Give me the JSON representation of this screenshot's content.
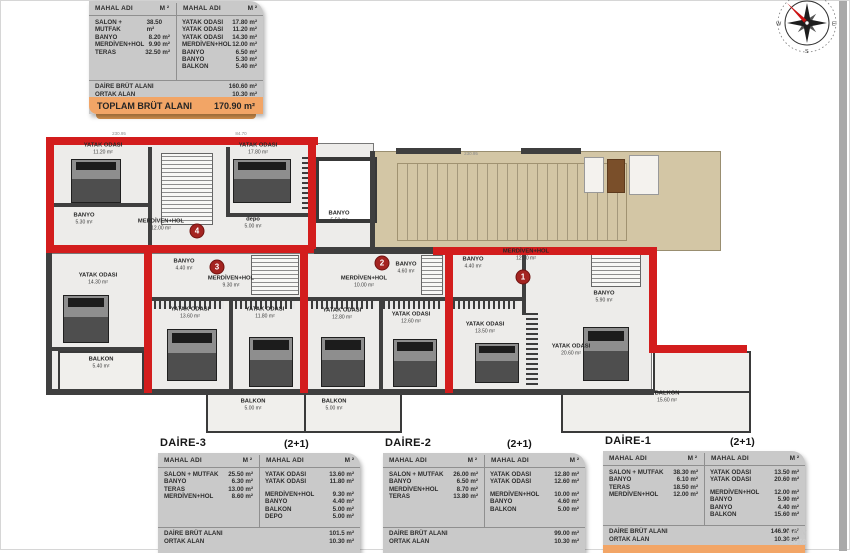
{
  "table_header": {
    "col": "MAHAL ADI",
    "unit": "M ²"
  },
  "summary_table": {
    "left_rows": [
      {
        "name": "SALON + MUTFAK",
        "value": "38.50 m²"
      },
      {
        "name": "BANYO",
        "value": "8.20 m²"
      },
      {
        "name": "MERDİVEN+HOL",
        "value": "9.90 m²"
      },
      {
        "name": "TERAS",
        "value": "32.50 m²"
      }
    ],
    "right_rows": [
      {
        "name": "YATAK ODASI",
        "value": "17.80 m²"
      },
      {
        "name": "YATAK ODASI",
        "value": "11.20 m²"
      },
      {
        "name": "YATAK ODASI",
        "value": "14.30 m²"
      },
      {
        "name": "MERDİVEN+HOL",
        "value": "12.00 m²"
      },
      {
        "name": "BANYO",
        "value": "6.50 m²"
      },
      {
        "name": "BANYO",
        "value": "5.30 m²"
      },
      {
        "name": "BALKON",
        "value": "5.40 m²"
      }
    ],
    "brut": {
      "label": "DAİRE BRÜT ALANI",
      "value": "160.60 m²"
    },
    "ortak": {
      "label": "ORTAK ALAN",
      "value": "10.30 m²"
    },
    "total": {
      "label": "TOPLAM BRÜT ALANI",
      "value": "170.90 m²"
    }
  },
  "apartments": [
    {
      "title": "DAİRE-3",
      "type": "(2+1)",
      "left_rows": [
        {
          "name": "SALON + MUTFAK",
          "value": "25.50 m²"
        },
        {
          "name": "BANYO",
          "value": "6.30 m²"
        },
        {
          "name": "TERAS",
          "value": "13.00 m²"
        },
        {
          "name": "MERDİVEN+HOL",
          "value": "8.60 m²"
        }
      ],
      "right_rows": [
        {
          "name": "YATAK ODASI",
          "value": "13.60 m²"
        },
        {
          "name": "YATAK ODASI",
          "value": "11.80 m²"
        },
        {
          "name": "MERDİVEN+HOL",
          "value": "9.30 m²"
        },
        {
          "name": "BANYO",
          "value": "4.40 m²"
        },
        {
          "name": "BALKON",
          "value": "5.00 m²"
        },
        {
          "name": "DEPO",
          "value": "5.00 m²"
        }
      ],
      "brut": {
        "label": "DAİRE BRÜT ALANI",
        "value": "101.5 m²"
      },
      "ortak": {
        "label": "ORTAK ALAN",
        "value": "10.30 m²"
      }
    },
    {
      "title": "DAİRE-2",
      "type": "(2+1)",
      "left_rows": [
        {
          "name": "SALON + MUTFAK",
          "value": "26.00 m²"
        },
        {
          "name": "BANYO",
          "value": "6.50 m²"
        },
        {
          "name": "MERDİVEN+HOL",
          "value": "8.70 m²"
        },
        {
          "name": "TERAS",
          "value": "13.80 m²"
        }
      ],
      "right_rows": [
        {
          "name": "YATAK ODASI",
          "value": "12.80 m²"
        },
        {
          "name": "YATAK ODASI",
          "value": "12.60 m²"
        },
        {
          "name": "MERDİVEN+HOL",
          "value": "10.00 m²"
        },
        {
          "name": "BANYO",
          "value": "4.60 m²"
        },
        {
          "name": "BALKON",
          "value": "5.00 m²"
        }
      ],
      "brut": {
        "label": "DAİRE BRÜT ALANI",
        "value": "99.00 m²"
      },
      "ortak": {
        "label": "ORTAK ALAN",
        "value": "10.30 m²"
      }
    },
    {
      "title": "DAİRE-1",
      "type": "(2+1)",
      "left_rows": [
        {
          "name": "SALON + MUTFAK",
          "value": "38.30 m²"
        },
        {
          "name": "BANYO",
          "value": "6.10 m²"
        },
        {
          "name": "TERAS",
          "value": "18.50 m²"
        },
        {
          "name": "MERDİVEN+HOL",
          "value": "12.00 m²"
        }
      ],
      "right_rows": [
        {
          "name": "YATAK ODASI",
          "value": "13.50 m²"
        },
        {
          "name": "YATAK ODASI",
          "value": "20.60 m²"
        },
        {
          "name": "MERDİVEN+HOL",
          "value": "12.00 m²"
        },
        {
          "name": "BANYO",
          "value": "5.90 m²"
        },
        {
          "name": "BANYO",
          "value": "4.40 m²"
        },
        {
          "name": "BALKON",
          "value": "15.60 m²"
        }
      ],
      "brut": {
        "label": "DAİRE BRÜT ALANI",
        "value": "146.90 m²"
      },
      "ortak": {
        "label": "ORTAK ALAN",
        "value": "10.30 m²"
      }
    }
  ],
  "plan": {
    "labels": [
      {
        "name": "YATAK ODASI",
        "area": "11.20 m²"
      },
      {
        "name": "YATAK ODASI",
        "area": "17.80 m²"
      },
      {
        "name": "BANYO",
        "area": "5.30 m²"
      },
      {
        "name": "MERDİVEN+HOL",
        "area": "12.00 m²"
      },
      {
        "name": "depo",
        "area": "5.00 m²"
      },
      {
        "name": "BANYO",
        "area": "5.50 m²"
      },
      {
        "name": "BANYO",
        "area": "4.40 m²"
      },
      {
        "name": "MERDİVEN+HOL",
        "area": "9.30 m²"
      },
      {
        "name": "BANYO",
        "area": "4.60 m²"
      },
      {
        "name": "MERDİVEN+HOL",
        "area": "10.00 m²"
      },
      {
        "name": "MERDİVEN+HOL",
        "area": "12.00 m²"
      },
      {
        "name": "BANYO",
        "area": "4.40 m²"
      },
      {
        "name": "BANYO",
        "area": "5.90 m²"
      },
      {
        "name": "YATAK ODASI",
        "area": "14.30 m²"
      },
      {
        "name": "YATAK ODASI",
        "area": "13.60 m²"
      },
      {
        "name": "YATAK ODASI",
        "area": "11.80 m²"
      },
      {
        "name": "YATAK ODASI",
        "area": "12.80 m²"
      },
      {
        "name": "YATAK ODASI",
        "area": "12.60 m²"
      },
      {
        "name": "YATAK ODASI",
        "area": "13.50 m²"
      },
      {
        "name": "YATAK ODASI",
        "area": "20.60 m²"
      },
      {
        "name": "BALKON",
        "area": "5.40 m²"
      },
      {
        "name": "BALKON",
        "area": "5.00 m²"
      },
      {
        "name": "BALKON",
        "area": "5.00 m²"
      },
      {
        "name": "BALKON",
        "area": "15.60 m²"
      }
    ],
    "unit_numbers": [
      "4",
      "3",
      "2",
      "1"
    ],
    "dims": [
      "230.95",
      "84.70",
      "230.95"
    ]
  },
  "compass": {
    "letters": [
      "W",
      "E",
      "S"
    ]
  },
  "watermark": {
    "line1": "Activ",
    "line2": "Go to"
  },
  "colors": {
    "wall_red": "#d31d1d",
    "wall_dark": "#3f3f3f",
    "terrace": "#d3c6a5",
    "table_bg": "#c9c9c9",
    "total_orange": "#f2a566"
  }
}
